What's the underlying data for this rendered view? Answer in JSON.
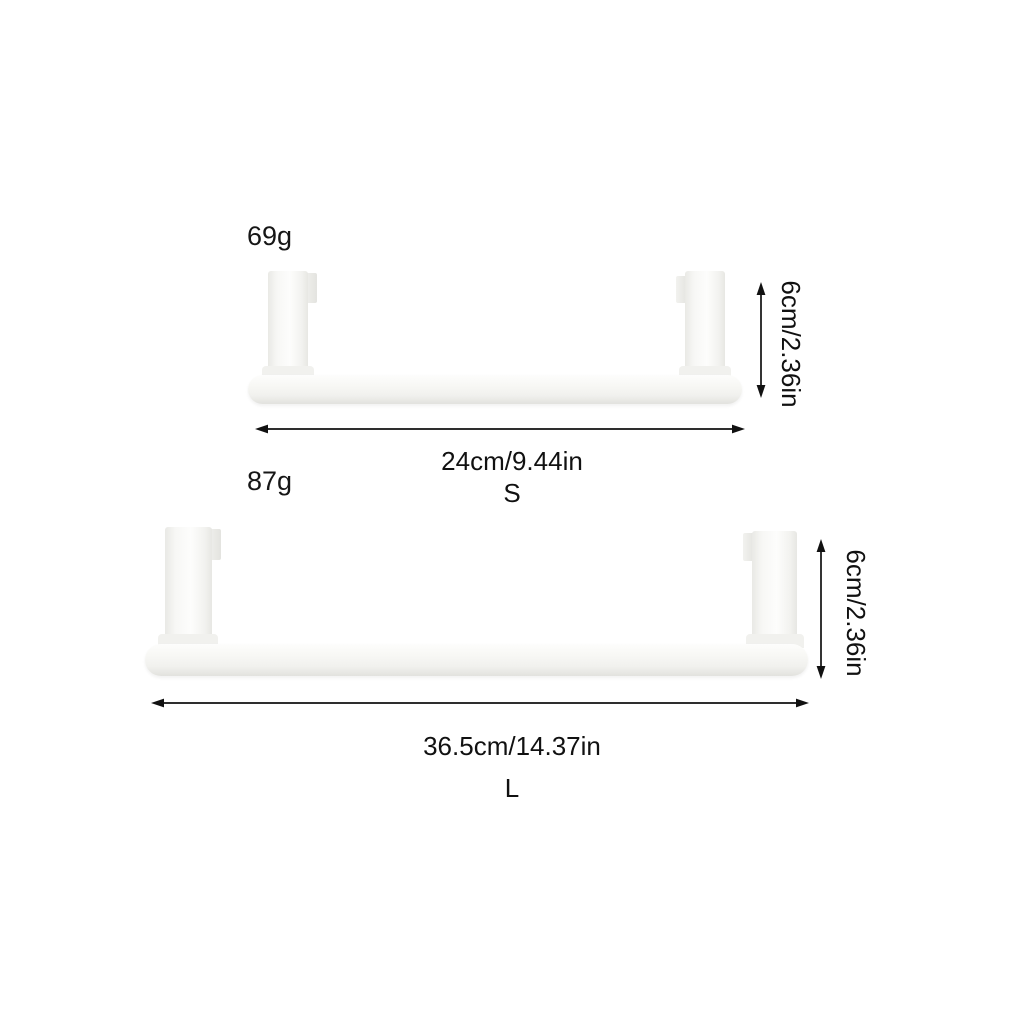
{
  "diagram": {
    "description": "over-door towel bar size chart, two sizes",
    "products": [
      {
        "size": "S",
        "weight": "69g",
        "length": "24cm/9.44in",
        "height": "6cm/2.36in"
      },
      {
        "size": "L",
        "weight": "87g",
        "length": "36.5cm/14.37in",
        "height": "6cm/2.36in"
      }
    ]
  },
  "colors": {
    "background": "#ffffff",
    "product_fill": "#f4f4f1",
    "product_edge": "#e3e3df",
    "annotation": "#111111"
  }
}
